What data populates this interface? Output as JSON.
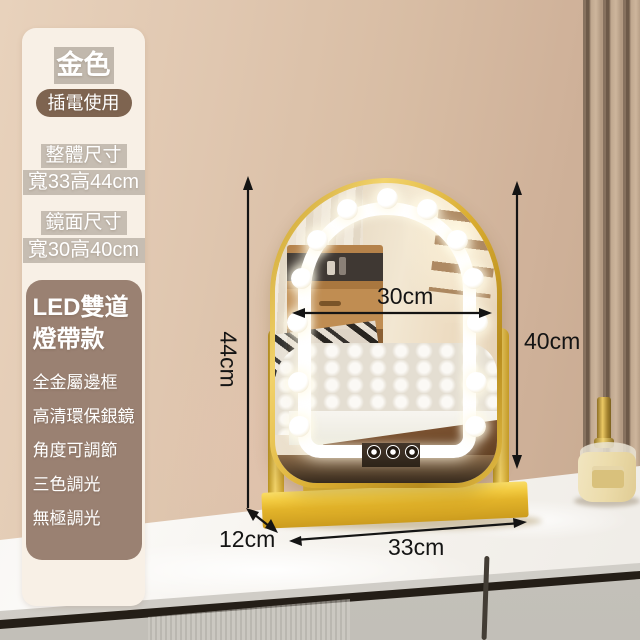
{
  "product_panel": {
    "color_label": "金色",
    "power_label": "插電使用",
    "overall_size": {
      "title": "整體尺寸",
      "value": "寬33高44cm"
    },
    "mirror_size": {
      "title": "鏡面尺寸",
      "value": "寬30高40cm"
    },
    "feature_box": {
      "title_line1": "LED雙道",
      "title_line2": "燈帶款",
      "features": [
        "全金屬邊框",
        "高清環保銀鏡",
        "角度可調節",
        "三色調光",
        "無極調光"
      ]
    }
  },
  "dimensions": {
    "overall_height": "44cm",
    "mirror_height": "40cm",
    "mirror_width": "30cm",
    "base_width": "33cm",
    "base_depth": "12cm"
  },
  "colors": {
    "frame_gold": "#E3B42A",
    "wall_tan": "#D8BDA4",
    "panel_cream": "#F8F0E6",
    "feature_box_brown": "#9A8172",
    "pill_brown": "#7E6450",
    "annotation_black": "#141414",
    "led_white": "#FFFFFF",
    "counter_white": "#F6F3EE"
  }
}
